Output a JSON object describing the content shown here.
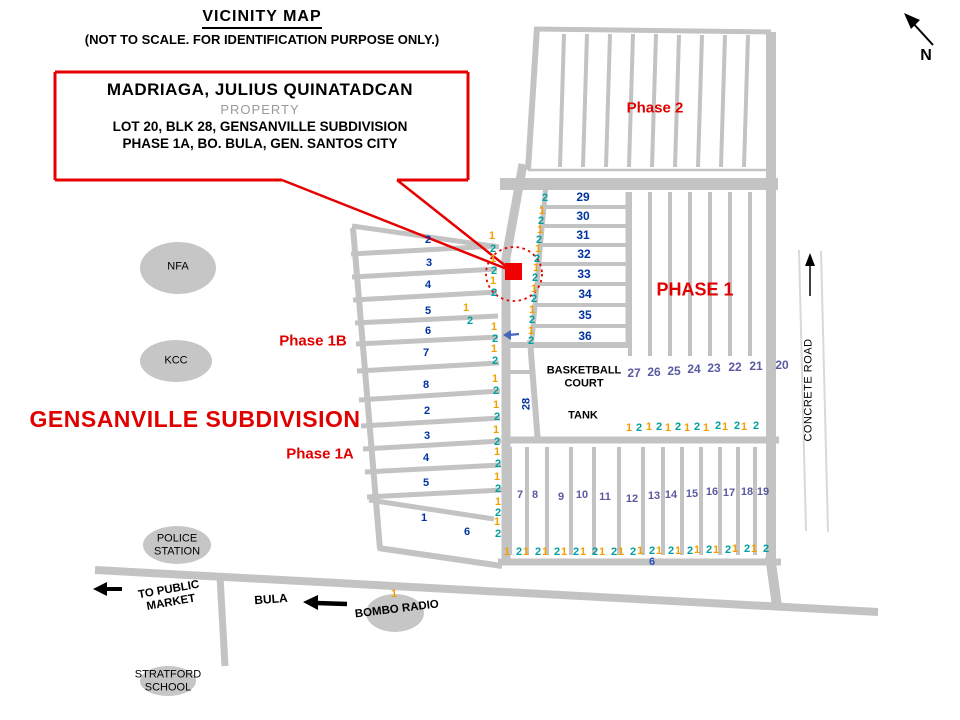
{
  "title": {
    "heading": "VICINITY MAP",
    "subtitle": "(NOT TO SCALE. FOR IDENTIFICATION PURPOSE ONLY.)"
  },
  "property_callout": {
    "owner": "MADRIAGA, JULIUS QUINATADCAN",
    "kind": "PROPERTY",
    "line3": "LOT 20, BLK 28, GENSANVILLE SUBDIVISION",
    "line4": "PHASE 1A, BO. BULA,  GEN. SANTOS CITY"
  },
  "region_labels": {
    "subdivision": "GENSANVILLE SUBDIVISION",
    "phase2": "Phase 2",
    "phase1": "PHASE 1",
    "phase1b": "Phase 1B",
    "phase1a": "Phase 1A"
  },
  "landmarks": {
    "nfa": "NFA",
    "kcc": "KCC",
    "police": "POLICE\nSTATION",
    "stratford": "STRATFORD\nSCHOOL",
    "bombo": "BOMBO RADIO",
    "bula": "BULA",
    "to_public_market": "TO PUBLIC\nMARKET",
    "basketball_court": "BASKETBALL\nCOURT",
    "tank": "TANK",
    "concrete_road": "CONCRETE ROAD",
    "road_28": "28",
    "north": "N"
  },
  "colors": {
    "road_gray": "#c3c3c3",
    "ellipse_gray": "#c6c6c6",
    "accent_red": "#e60000",
    "navy_numbers": "#0033a0",
    "purple_numbers": "#5a5aa0",
    "marker_one_orange": "#f0a000",
    "marker_two_teal": "#00a0a0",
    "misc_blue": "#2a52be"
  },
  "map": {
    "number_groups": [
      {
        "name": "street-number-phase1b1a",
        "color": "#0033a0",
        "size": 11,
        "items": [
          [
            "2",
            428,
            240
          ],
          [
            "3",
            429,
            263
          ],
          [
            "4",
            428,
            285
          ],
          [
            "5",
            428,
            311
          ],
          [
            "6",
            428,
            331
          ],
          [
            "7",
            426,
            353
          ],
          [
            "8",
            426,
            385
          ],
          [
            "2",
            427,
            411
          ],
          [
            "3",
            427,
            436
          ],
          [
            "4",
            426,
            458
          ],
          [
            "5",
            426,
            483
          ],
          [
            "1",
            424,
            518
          ],
          [
            "6",
            467,
            532
          ]
        ]
      },
      {
        "name": "street-number-29-36",
        "color": "#0033a0",
        "size": 12,
        "items": [
          [
            "29",
            583,
            197
          ],
          [
            "30",
            583,
            216
          ],
          [
            "31",
            583,
            235
          ],
          [
            "32",
            584,
            254
          ],
          [
            "33",
            584,
            274
          ],
          [
            "34",
            585,
            294
          ],
          [
            "35",
            585,
            315
          ],
          [
            "36",
            585,
            336
          ]
        ]
      },
      {
        "name": "street-number-20-27",
        "color": "#5a5aa0",
        "size": 12,
        "items": [
          [
            "27",
            634,
            373
          ],
          [
            "26",
            654,
            372
          ],
          [
            "25",
            674,
            371
          ],
          [
            "24",
            694,
            369
          ],
          [
            "23",
            714,
            368
          ],
          [
            "22",
            735,
            367
          ],
          [
            "21",
            756,
            366
          ],
          [
            "20",
            782,
            365
          ]
        ]
      },
      {
        "name": "street-number-7-19",
        "color": "#5a5aa0",
        "size": 11,
        "items": [
          [
            "7",
            520,
            495
          ],
          [
            "8",
            535,
            495
          ],
          [
            "9",
            561,
            497
          ],
          [
            "10",
            582,
            495
          ],
          [
            "11",
            605,
            497
          ],
          [
            "12",
            632,
            499
          ],
          [
            "13",
            654,
            496
          ],
          [
            "14",
            671,
            495
          ],
          [
            "15",
            692,
            494
          ],
          [
            "16",
            712,
            492
          ],
          [
            "17",
            729,
            493
          ],
          [
            "18",
            747,
            492
          ],
          [
            "19",
            763,
            492
          ]
        ]
      },
      {
        "name": "street-number-6",
        "color": "#2a52be",
        "size": 11,
        "items": [
          [
            "6",
            652,
            562
          ]
        ]
      }
    ],
    "lot_markers": {
      "colors": {
        "1": "#f0a000",
        "2": "#00a0a0"
      },
      "items": [
        [
          "1",
          492,
          236
        ],
        [
          "2",
          493,
          249
        ],
        [
          "1",
          493,
          259
        ],
        [
          "2",
          494,
          271
        ],
        [
          "1",
          493,
          281
        ],
        [
          "2",
          494,
          293
        ],
        [
          "1",
          466,
          308
        ],
        [
          "2",
          470,
          321
        ],
        [
          "1",
          494,
          327
        ],
        [
          "2",
          495,
          339
        ],
        [
          "1",
          494,
          349
        ],
        [
          "2",
          495,
          361
        ],
        [
          "1",
          495,
          379
        ],
        [
          "2",
          496,
          391
        ],
        [
          "1",
          496,
          405
        ],
        [
          "2",
          497,
          417
        ],
        [
          "1",
          496,
          430
        ],
        [
          "2",
          497,
          442
        ],
        [
          "1",
          497,
          452
        ],
        [
          "2",
          498,
          464
        ],
        [
          "1",
          497,
          477
        ],
        [
          "2",
          498,
          489
        ],
        [
          "1",
          498,
          502
        ],
        [
          "2",
          498,
          513
        ],
        [
          "1",
          497,
          522
        ],
        [
          "2",
          498,
          534
        ],
        [
          "2",
          545,
          198
        ],
        [
          "1",
          542,
          211
        ],
        [
          "2",
          541,
          221
        ],
        [
          "1",
          540,
          230
        ],
        [
          "2",
          539,
          240
        ],
        [
          "1",
          538,
          249
        ],
        [
          "2",
          537,
          259
        ],
        [
          "1",
          536,
          268
        ],
        [
          "2",
          535,
          278
        ],
        [
          "1",
          534,
          289
        ],
        [
          "2",
          534,
          299
        ],
        [
          "1",
          532,
          310
        ],
        [
          "2",
          532,
          320
        ],
        [
          "1",
          531,
          331
        ],
        [
          "2",
          531,
          341
        ],
        [
          "1",
          629,
          428
        ],
        [
          "2",
          639,
          428
        ],
        [
          "1",
          649,
          427
        ],
        [
          "2",
          659,
          427
        ],
        [
          "1",
          668,
          428
        ],
        [
          "2",
          678,
          427
        ],
        [
          "1",
          687,
          428
        ],
        [
          "2",
          697,
          427
        ],
        [
          "1",
          706,
          428
        ],
        [
          "2",
          718,
          426
        ],
        [
          "1",
          725,
          427
        ],
        [
          "2",
          737,
          426
        ],
        [
          "1",
          744,
          427
        ],
        [
          "2",
          756,
          426
        ],
        [
          "1",
          507,
          552
        ],
        [
          "2",
          519,
          552
        ],
        [
          "1",
          526,
          552
        ],
        [
          "2",
          538,
          552
        ],
        [
          "1",
          545,
          552
        ],
        [
          "2",
          557,
          552
        ],
        [
          "1",
          564,
          552
        ],
        [
          "2",
          576,
          552
        ],
        [
          "1",
          583,
          552
        ],
        [
          "2",
          595,
          552
        ],
        [
          "1",
          602,
          552
        ],
        [
          "2",
          614,
          552
        ],
        [
          "1",
          621,
          552
        ],
        [
          "2",
          633,
          552
        ],
        [
          "1",
          640,
          551
        ],
        [
          "2",
          652,
          551
        ],
        [
          "1",
          659,
          551
        ],
        [
          "2",
          671,
          551
        ],
        [
          "1",
          678,
          551
        ],
        [
          "2",
          690,
          551
        ],
        [
          "1",
          697,
          550
        ],
        [
          "2",
          709,
          550
        ],
        [
          "1",
          716,
          550
        ],
        [
          "2",
          728,
          550
        ],
        [
          "1",
          735,
          549
        ],
        [
          "2",
          747,
          549
        ],
        [
          "1",
          754,
          549
        ],
        [
          "2",
          766,
          549
        ],
        [
          "1",
          394,
          594
        ]
      ]
    }
  }
}
